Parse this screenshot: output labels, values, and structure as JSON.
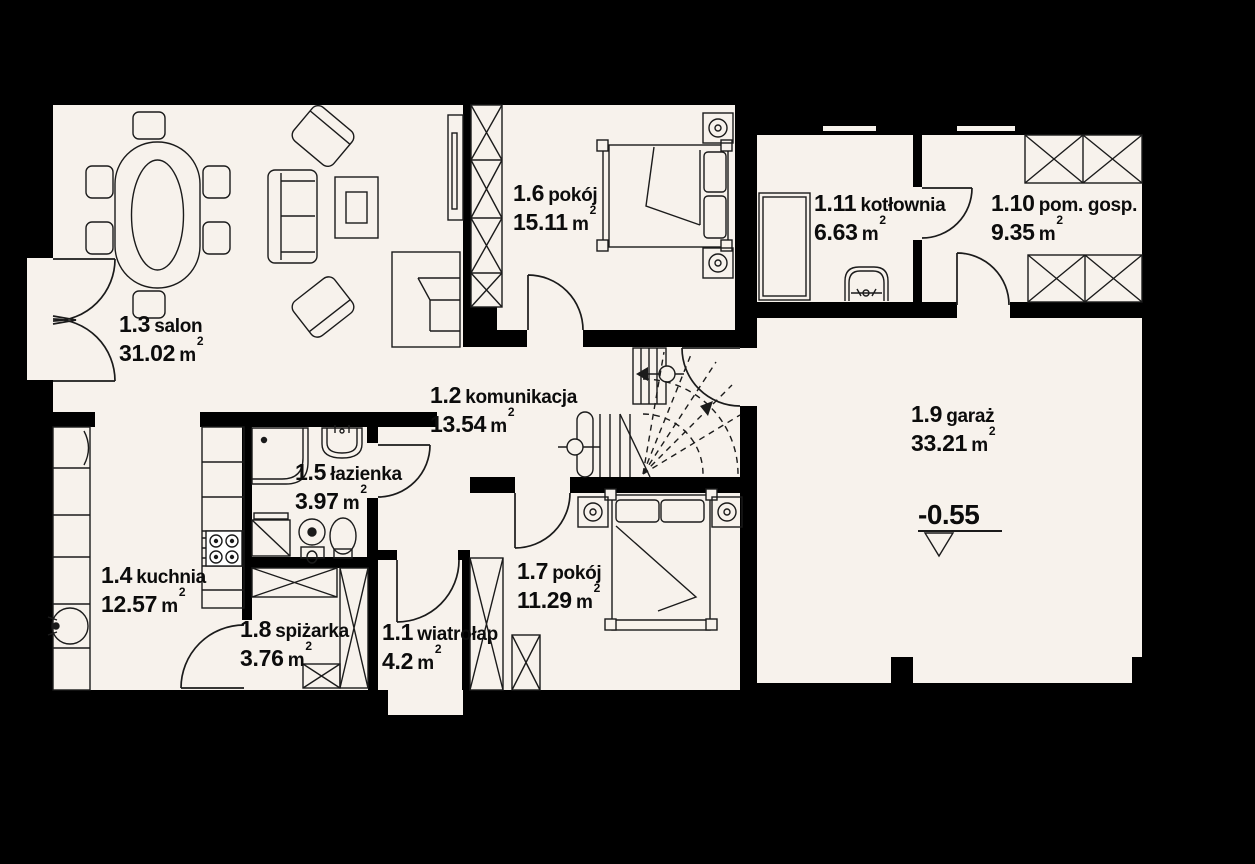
{
  "colors": {
    "background": "#000000",
    "floor": "#f7f2ec",
    "wall": "#000000",
    "line": "#1b1b1b",
    "text": "#0c0c0c"
  },
  "rooms": [
    {
      "number": "1.1",
      "name": "wiatrołap",
      "area": "4.2",
      "unit": "m",
      "sup": "2"
    },
    {
      "number": "1.2",
      "name": "komunikacja",
      "area": "13.54",
      "unit": "m",
      "sup": "2"
    },
    {
      "number": "1.3",
      "name": "salon",
      "area": "31.02",
      "unit": "m",
      "sup": "2"
    },
    {
      "number": "1.4",
      "name": "kuchnia",
      "area": "12.57",
      "unit": "m",
      "sup": "2"
    },
    {
      "number": "1.5",
      "name": "łazienka",
      "area": "3.97",
      "unit": "m",
      "sup": "2"
    },
    {
      "number": "1.6",
      "name": "pokój",
      "area": "15.11",
      "unit": "m",
      "sup": "2"
    },
    {
      "number": "1.7",
      "name": "pokój",
      "area": "11.29",
      "unit": "m",
      "sup": "2"
    },
    {
      "number": "1.8",
      "name": "spiżarka",
      "area": "3.76",
      "unit": "m",
      "sup": "2"
    },
    {
      "number": "1.9",
      "name": "garaż",
      "area": "33.21",
      "unit": "m",
      "sup": "2"
    },
    {
      "number": "1.10",
      "name": "pom. gosp.",
      "area": "9.35",
      "unit": "m",
      "sup": "2"
    },
    {
      "number": "1.11",
      "name": "kotłownia",
      "area": "6.63",
      "unit": "m",
      "sup": "2"
    }
  ],
  "level_marker": {
    "value": "-0.55"
  },
  "symbols": [
    "dining-table",
    "chair",
    "sofa",
    "armchair",
    "coffee-table",
    "tv-cabinet",
    "fireplace",
    "wardrobe",
    "double-bed",
    "nightstand",
    "stairs",
    "shower",
    "washbasin",
    "washing-machine",
    "toilet",
    "bidet",
    "kitchen-counter",
    "kitchen-sink",
    "stove",
    "pantry-shelves",
    "boiler",
    "utility-basin",
    "storage-cabinet",
    "door-swing",
    "window",
    "level-marker"
  ]
}
